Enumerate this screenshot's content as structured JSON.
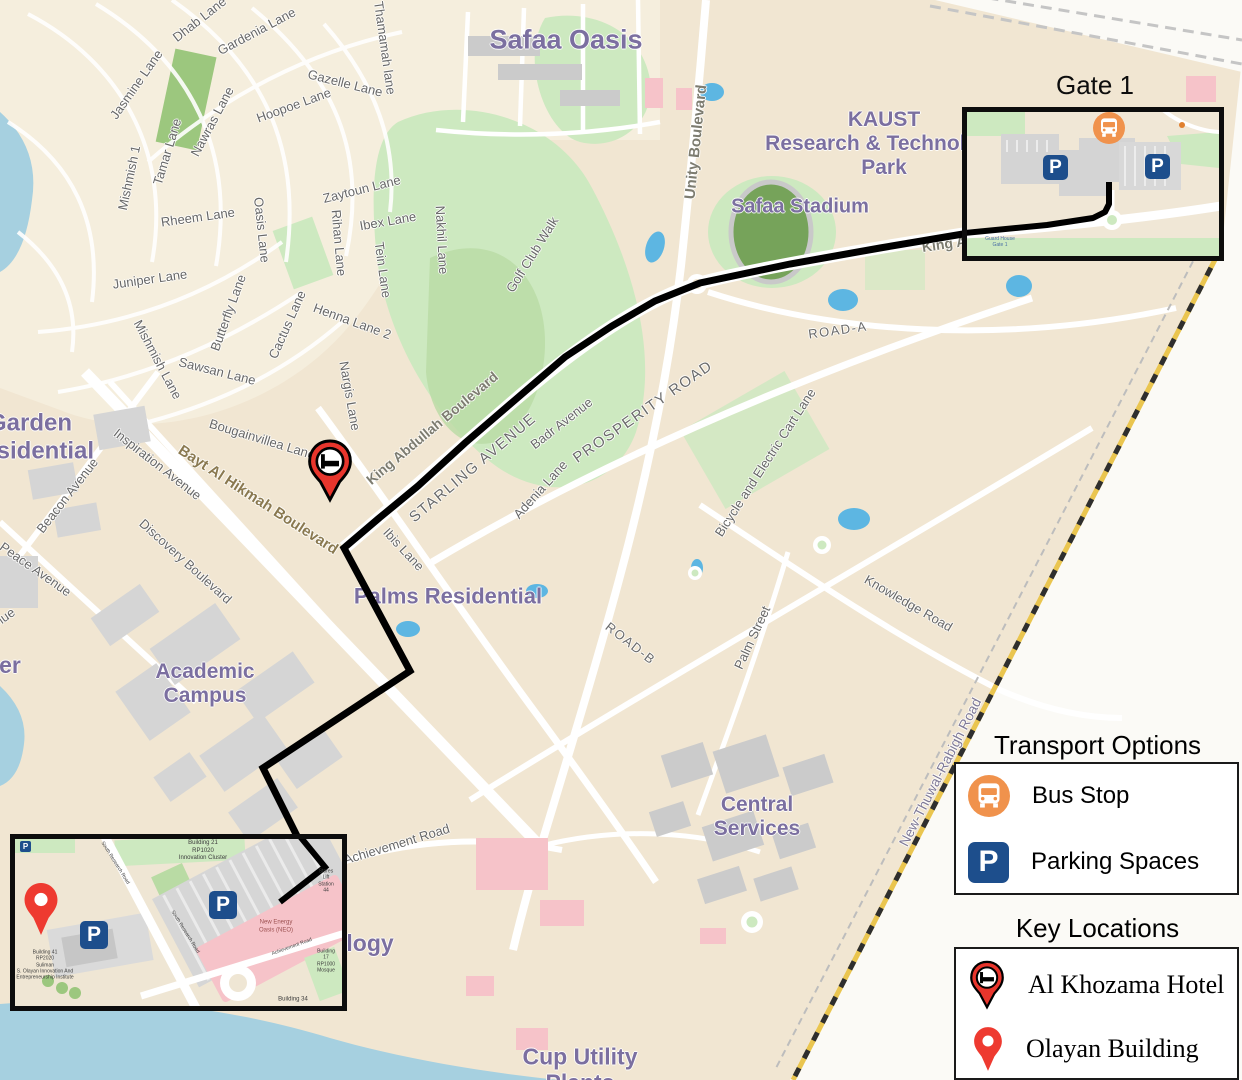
{
  "titles": {
    "gate1": "Gate 1",
    "transport": "Transport Options",
    "key_locations": "Key Locations"
  },
  "legend": {
    "transport": [
      {
        "icon": "bus-icon",
        "label": "Bus Stop"
      },
      {
        "icon": "parking-icon",
        "label": "Parking Spaces"
      }
    ],
    "key_locations": [
      {
        "icon": "hotel-pin-icon",
        "label": "Al Khozama Hotel"
      },
      {
        "icon": "location-pin-icon",
        "label": "Olayan Building"
      }
    ]
  },
  "icons": {
    "parking_glyph": "P"
  },
  "colors": {
    "route_black": "#000000",
    "bus_orange": "#f0924c",
    "parking_blue": "#1d4e8c",
    "pin_red": "#ee3a30",
    "district_purple": "#7b6fa0",
    "water_blue": "#a6d0e0",
    "golf_green": "#cde9c0",
    "land_beige": "#f1e6d2",
    "highway_yellow": "#eac54f"
  },
  "map": {
    "labels": [
      {
        "text": "Safaa Oasis",
        "x": 566,
        "y": 40,
        "fs": 27,
        "cls": "district"
      },
      {
        "text": "KAUST\nResearch & Technology\nPark",
        "x": 884,
        "y": 144,
        "fs": 21,
        "cls": "district"
      },
      {
        "text": "Safaa Stadium",
        "x": 800,
        "y": 207,
        "fs": 20,
        "cls": "district"
      },
      {
        "text": "Garden\nResidential",
        "x": 30,
        "y": 437,
        "fs": 24,
        "cls": "district"
      },
      {
        "text": "Academic\nCampus",
        "x": 205,
        "y": 684,
        "fs": 21,
        "cls": "district"
      },
      {
        "text": "Palms Residential",
        "x": 448,
        "y": 596,
        "fs": 22,
        "cls": "district"
      },
      {
        "text": "Central\nServices",
        "x": 757,
        "y": 817,
        "fs": 21,
        "cls": "district"
      },
      {
        "text": "Cup Utility\nPlants",
        "x": 580,
        "y": 1070,
        "fs": 23,
        "cls": "district"
      },
      {
        "text": "er",
        "x": 10,
        "y": 665,
        "fs": 23,
        "cls": "district"
      },
      {
        "text": "Technology",
        "x": 330,
        "y": 943,
        "fs": 23,
        "cls": "district"
      },
      {
        "text": "Jasmine Lane",
        "x": 137,
        "y": 85,
        "rot": -55
      },
      {
        "text": "Dhab Lane",
        "x": 200,
        "y": 20,
        "rot": -38
      },
      {
        "text": "Gardenia Lane",
        "x": 257,
        "y": 32,
        "rot": -28
      },
      {
        "text": "Gazelle Lane",
        "x": 345,
        "y": 84,
        "rot": 14
      },
      {
        "text": "Hoopoe Lane",
        "x": 294,
        "y": 106,
        "rot": -20
      },
      {
        "text": "Thamamah lane",
        "x": 384,
        "y": 48,
        "rot": 82
      },
      {
        "text": "Nawras Lane",
        "x": 213,
        "y": 122,
        "rot": -62
      },
      {
        "text": "Tamar Lane",
        "x": 168,
        "y": 152,
        "rot": -73
      },
      {
        "text": "Mishmish 1",
        "x": 130,
        "y": 178,
        "rot": -78
      },
      {
        "text": "Rheem Lane",
        "x": 198,
        "y": 218,
        "rot": -8
      },
      {
        "text": "Oasis Lane",
        "x": 261,
        "y": 230,
        "rot": 84
      },
      {
        "text": "Zaytoun Lane",
        "x": 362,
        "y": 190,
        "rot": -14
      },
      {
        "text": "Ibex Lane",
        "x": 388,
        "y": 222,
        "rot": -10
      },
      {
        "text": "Rihan Lane",
        "x": 338,
        "y": 243,
        "rot": 85
      },
      {
        "text": "Tein Lane",
        "x": 382,
        "y": 270,
        "rot": 82
      },
      {
        "text": "Nakhil Lane",
        "x": 441,
        "y": 240,
        "rot": 87
      },
      {
        "text": "Golf Club Walk",
        "x": 533,
        "y": 255,
        "rot": -58
      },
      {
        "text": "Juniper Lane",
        "x": 150,
        "y": 280,
        "rot": -8
      },
      {
        "text": "Mishmish Lane",
        "x": 157,
        "y": 360,
        "rot": 62
      },
      {
        "text": "Butterfly Lane",
        "x": 229,
        "y": 313,
        "rot": -70
      },
      {
        "text": "Cactus Lane",
        "x": 288,
        "y": 325,
        "rot": -66
      },
      {
        "text": "Henna Lane 2",
        "x": 352,
        "y": 322,
        "rot": 20
      },
      {
        "text": "Sawsan Lane",
        "x": 217,
        "y": 372,
        "rot": 14
      },
      {
        "text": "Nargis Lane",
        "x": 349,
        "y": 396,
        "rot": 80
      },
      {
        "text": "Bougainvillea Lane",
        "x": 262,
        "y": 440,
        "rot": 17
      },
      {
        "text": "Inspiration Avenue",
        "x": 157,
        "y": 465,
        "rot": 38
      },
      {
        "text": "Beacon Avenue",
        "x": 68,
        "y": 496,
        "rot": -52
      },
      {
        "text": "Peace Avenue",
        "x": 35,
        "y": 570,
        "rot": 35
      },
      {
        "text": "Avenue",
        "x": -4,
        "y": 624,
        "rot": -35
      },
      {
        "text": "Discovery Boulevard",
        "x": 185,
        "y": 562,
        "rot": 42
      },
      {
        "text": "Badr Avenue",
        "x": 562,
        "y": 424,
        "rot": -38
      },
      {
        "text": "Adenia Lane",
        "x": 541,
        "y": 490,
        "rot": -48
      },
      {
        "text": "Ibis Lane",
        "x": 403,
        "y": 550,
        "rot": 47
      },
      {
        "text": "Bicycle and Electric Cart Lane",
        "x": 766,
        "y": 463,
        "rot": -57
      },
      {
        "text": "Knowledge Road",
        "x": 908,
        "y": 604,
        "rot": 30
      },
      {
        "text": "Palm Street",
        "x": 753,
        "y": 638,
        "rot": -65
      },
      {
        "text": "Achievement Road",
        "x": 397,
        "y": 845,
        "rot": -17
      },
      {
        "text": "STARLING AVENUE",
        "x": 473,
        "y": 468,
        "rot": -40,
        "fs": 15,
        "cls": "caps"
      },
      {
        "text": "PROSPERITY ROAD",
        "x": 643,
        "y": 412,
        "rot": -35,
        "fs": 15,
        "cls": "caps"
      },
      {
        "text": "ROAD-A",
        "x": 838,
        "y": 331,
        "rot": -8,
        "fs": 13,
        "cls": "caps"
      },
      {
        "text": "ROAD-B",
        "x": 630,
        "y": 644,
        "rot": 38,
        "fs": 13,
        "cls": "caps"
      },
      {
        "text": "King Abdullah Boulevard",
        "x": 432,
        "y": 428,
        "rot": -40,
        "fs": 14,
        "cls": "bold"
      },
      {
        "text": "Unity Boulevard",
        "x": 696,
        "y": 142,
        "rot": -84,
        "fs": 15,
        "cls": "bold"
      },
      {
        "text": "King A",
        "x": 944,
        "y": 244,
        "rot": -8,
        "fs": 14,
        "cls": "bold"
      },
      {
        "text": "Bayt Al Hikmah Boulevard",
        "x": 258,
        "y": 500,
        "rot": 33,
        "fs": 15,
        "cls": "olive"
      },
      {
        "text": "New-Thuwal-Rabigh Road",
        "x": 940,
        "y": 772,
        "rot": -63,
        "fs": 14,
        "cls": "newroad"
      },
      {
        "text": "Guard House\nGate 1",
        "x": 33,
        "y": 130,
        "fs": 5,
        "cls": "tinyblue",
        "layer": "gate1"
      },
      {
        "text": "Building 21\nRP1020\nInnovation Cluster",
        "x": 188,
        "y": 12,
        "fs": 6,
        "cls": "tiny",
        "layer": "olayan"
      },
      {
        "text": "Stores Lift\nStation 44",
        "x": 311,
        "y": 42,
        "fs": 5,
        "cls": "tiny",
        "layer": "olayan"
      },
      {
        "text": "New Energy\nOasis (NEO)",
        "x": 261,
        "y": 88,
        "fs": 6,
        "cls": "tinyred",
        "layer": "olayan"
      },
      {
        "text": "Building 41\nRP2020\nSuliman\nS. Olayan Innovation And\nEntrepreneurship Institute",
        "x": 30,
        "y": 126,
        "fs": 5,
        "cls": "tiny",
        "layer": "olayan"
      },
      {
        "text": "Building 17\nRP1000\nMosque",
        "x": 311,
        "y": 122,
        "fs": 5,
        "cls": "tiny",
        "layer": "olayan"
      },
      {
        "text": "Building 34",
        "x": 278,
        "y": 161,
        "fs": 6,
        "cls": "tiny",
        "layer": "olayan"
      },
      {
        "text": "South Research Road",
        "x": 100,
        "y": 24,
        "rot": 58,
        "fs": 5,
        "cls": "tiny",
        "layer": "olayan"
      },
      {
        "text": "South Research Road",
        "x": 170,
        "y": 93,
        "rot": 58,
        "fs": 5,
        "cls": "tiny",
        "layer": "olayan"
      },
      {
        "text": "Achievement Road",
        "x": 277,
        "y": 108,
        "rot": -20,
        "fs": 5,
        "cls": "tiny",
        "layer": "olayan"
      }
    ]
  },
  "routes": {
    "main": [
      [
        963,
        234
      ],
      [
        880,
        248
      ],
      [
        790,
        264
      ],
      [
        700,
        283
      ],
      [
        655,
        301
      ],
      [
        612,
        326
      ],
      [
        565,
        357
      ],
      [
        515,
        400
      ],
      [
        465,
        443
      ],
      [
        418,
        486
      ],
      [
        378,
        519
      ],
      [
        344,
        548
      ],
      [
        410,
        671
      ],
      [
        263,
        768
      ],
      [
        298,
        838
      ]
    ],
    "gate1": [
      [
        142,
        70
      ],
      [
        142,
        92
      ],
      [
        138,
        100
      ],
      [
        126,
        106
      ],
      [
        80,
        113
      ],
      [
        -3,
        121
      ]
    ],
    "olayan": [
      [
        283,
        -5
      ],
      [
        310,
        28
      ],
      [
        265,
        63
      ]
    ]
  }
}
